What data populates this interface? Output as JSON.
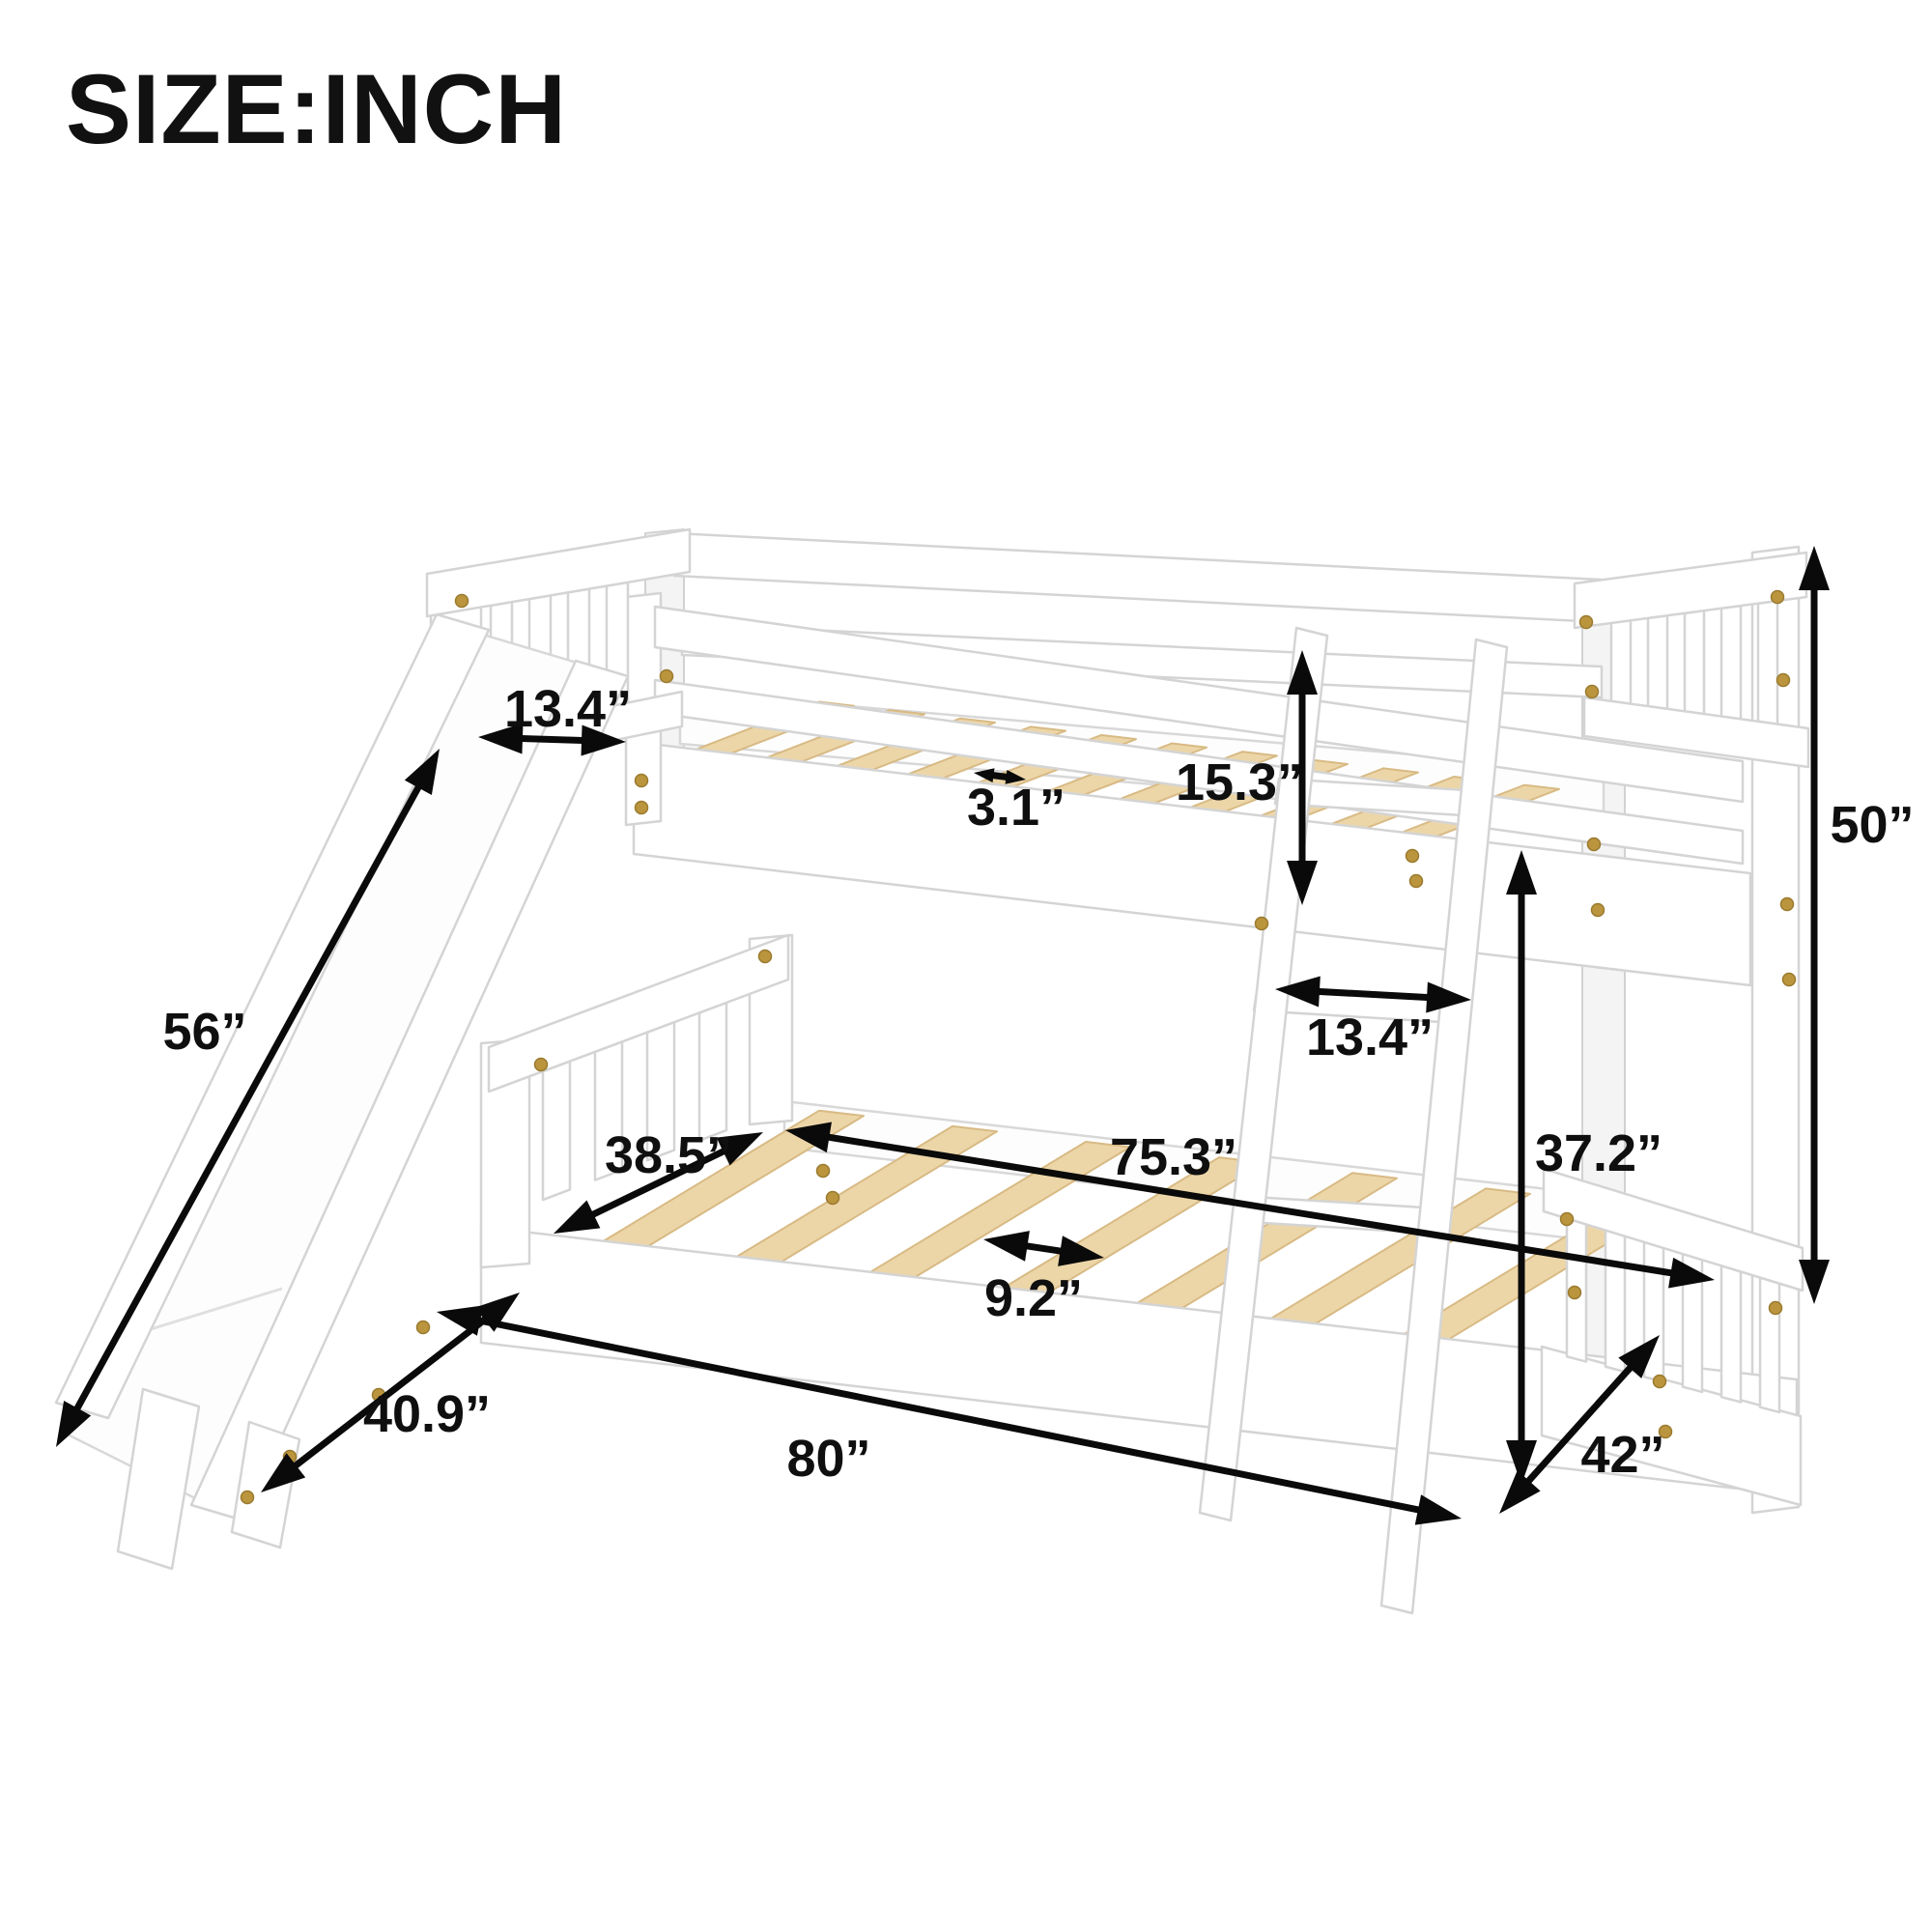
{
  "title": "SIZE:INCH",
  "unit": "inch",
  "product": "twin bunk bed with slide and ladder dimension diagram",
  "colors": {
    "background": "#ffffff",
    "bed_white": "#ffffff",
    "outline_gray": "#d4d4d4",
    "slat_wood": "#ecd6a8",
    "screw_gold": "#bb953e",
    "annotation_black": "#0a0a0a"
  },
  "dims": [
    {
      "name": "slide-entry-width",
      "label": "13.4”"
    },
    {
      "name": "upper-slat-spacing",
      "label": "3.1”"
    },
    {
      "name": "upper-guardrail-height",
      "label": "15.3”"
    },
    {
      "name": "overall-height",
      "label": "50”"
    },
    {
      "name": "slide-length",
      "label": "56”"
    },
    {
      "name": "lower-bed-inner-width",
      "label": "38.5”"
    },
    {
      "name": "upper-bed-inner-length",
      "label": "75.3”"
    },
    {
      "name": "ladder-width",
      "label": "13.4”"
    },
    {
      "name": "lower-section-height",
      "label": "37.2”"
    },
    {
      "name": "lower-slat-spacing",
      "label": "9.2”"
    },
    {
      "name": "slide-footprint-depth",
      "label": "40.9”"
    },
    {
      "name": "overall-length",
      "label": "80”"
    },
    {
      "name": "overall-depth",
      "label": "42”"
    }
  ]
}
